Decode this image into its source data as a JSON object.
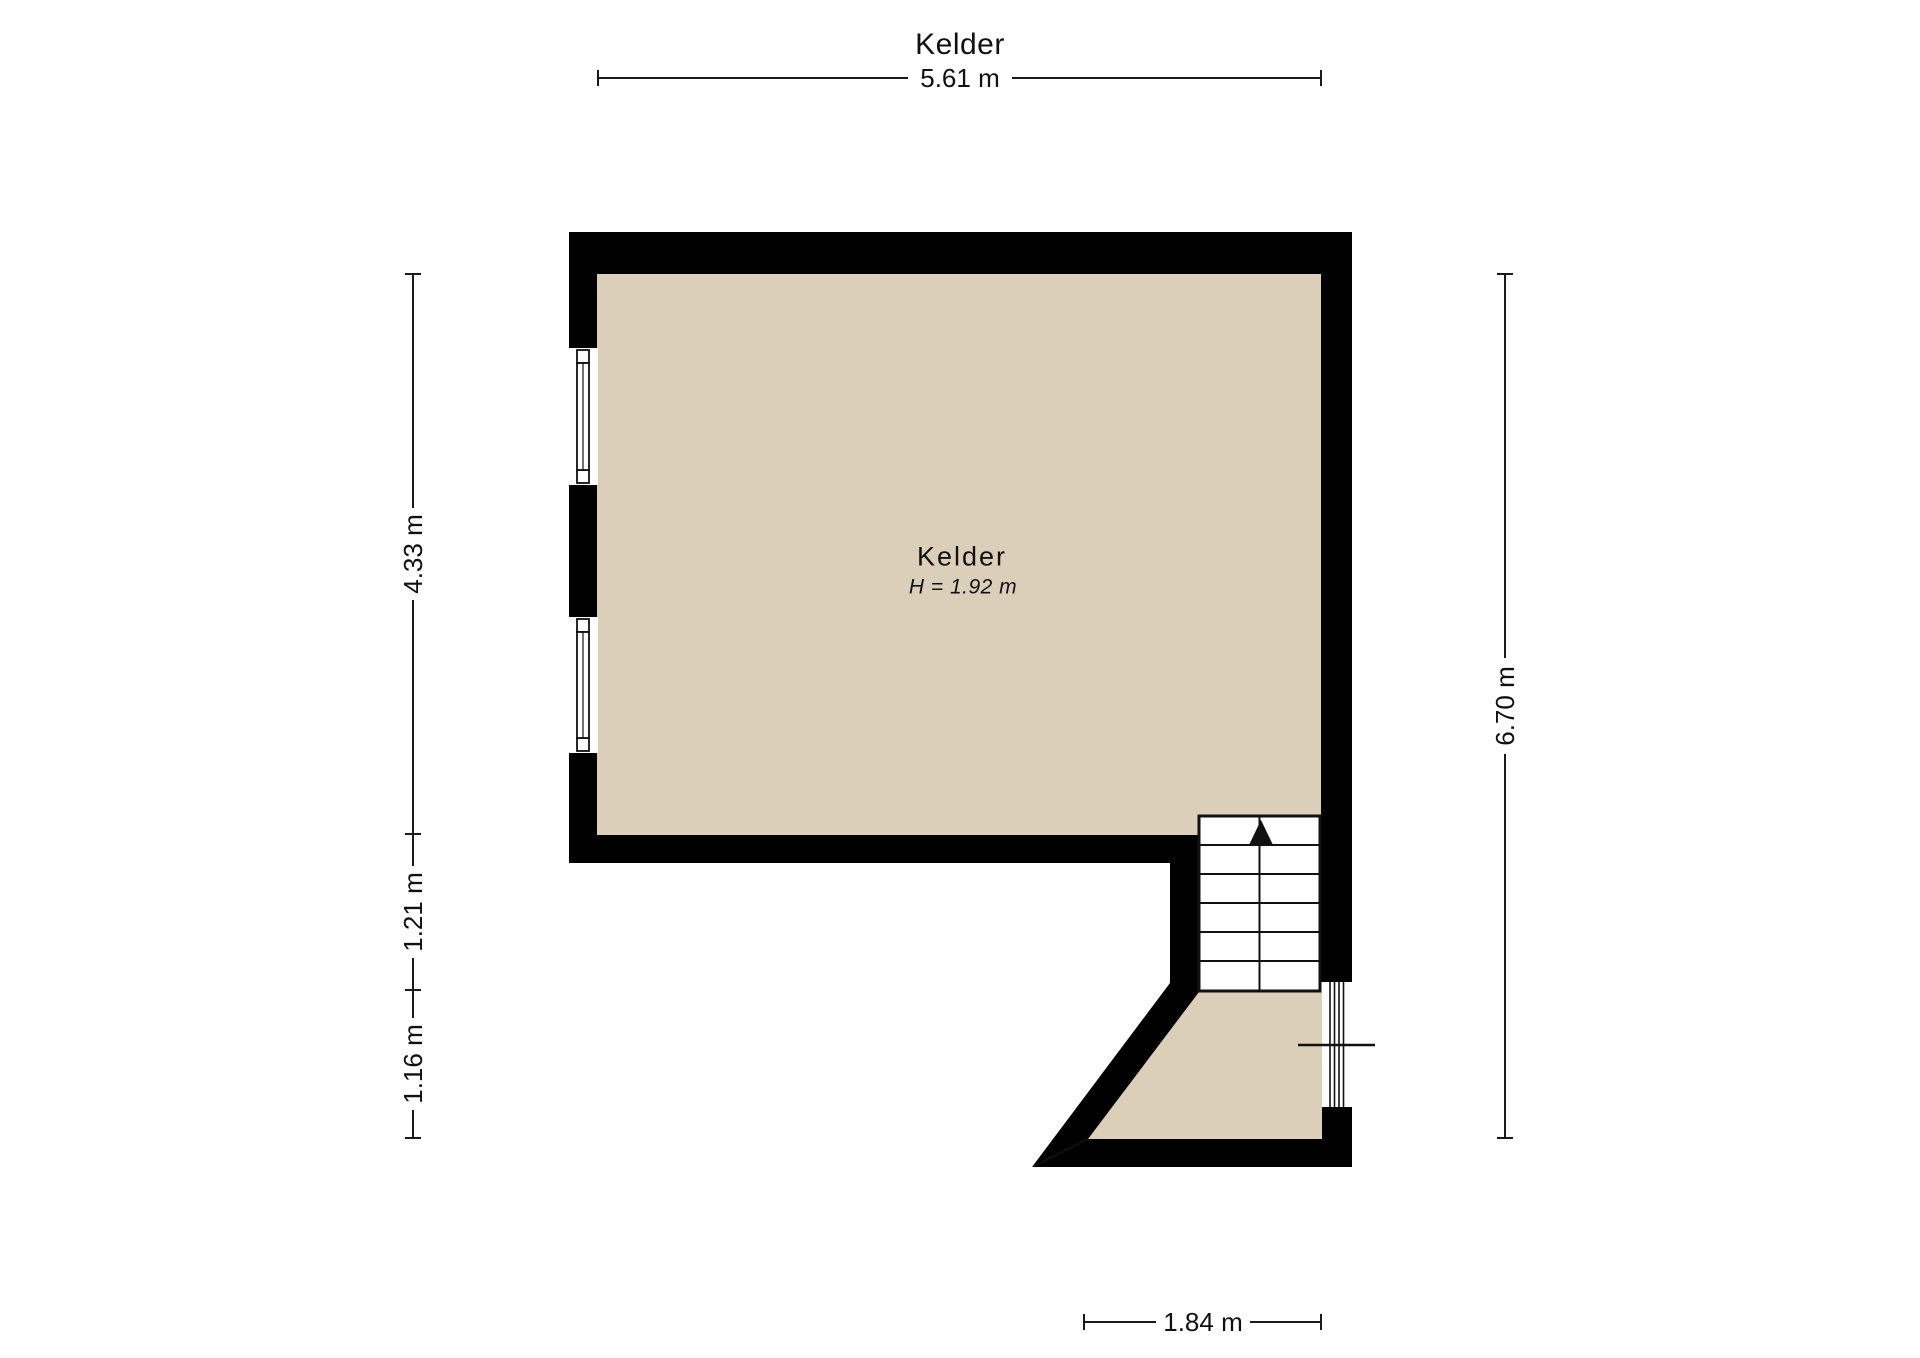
{
  "floorplan": {
    "title": "Kelder",
    "room": {
      "name": "Kelder",
      "height_label": "H = 1.92 m"
    },
    "dimensions": {
      "top": "5.61 m",
      "left": [
        "4.33 m",
        "1.21 m",
        "1.16 m"
      ],
      "right": "6.70 m",
      "bottom": "1.84 m"
    },
    "colors": {
      "floor": "#dccfb9",
      "wall": "#000000",
      "outline": "#1a1a1a"
    }
  }
}
